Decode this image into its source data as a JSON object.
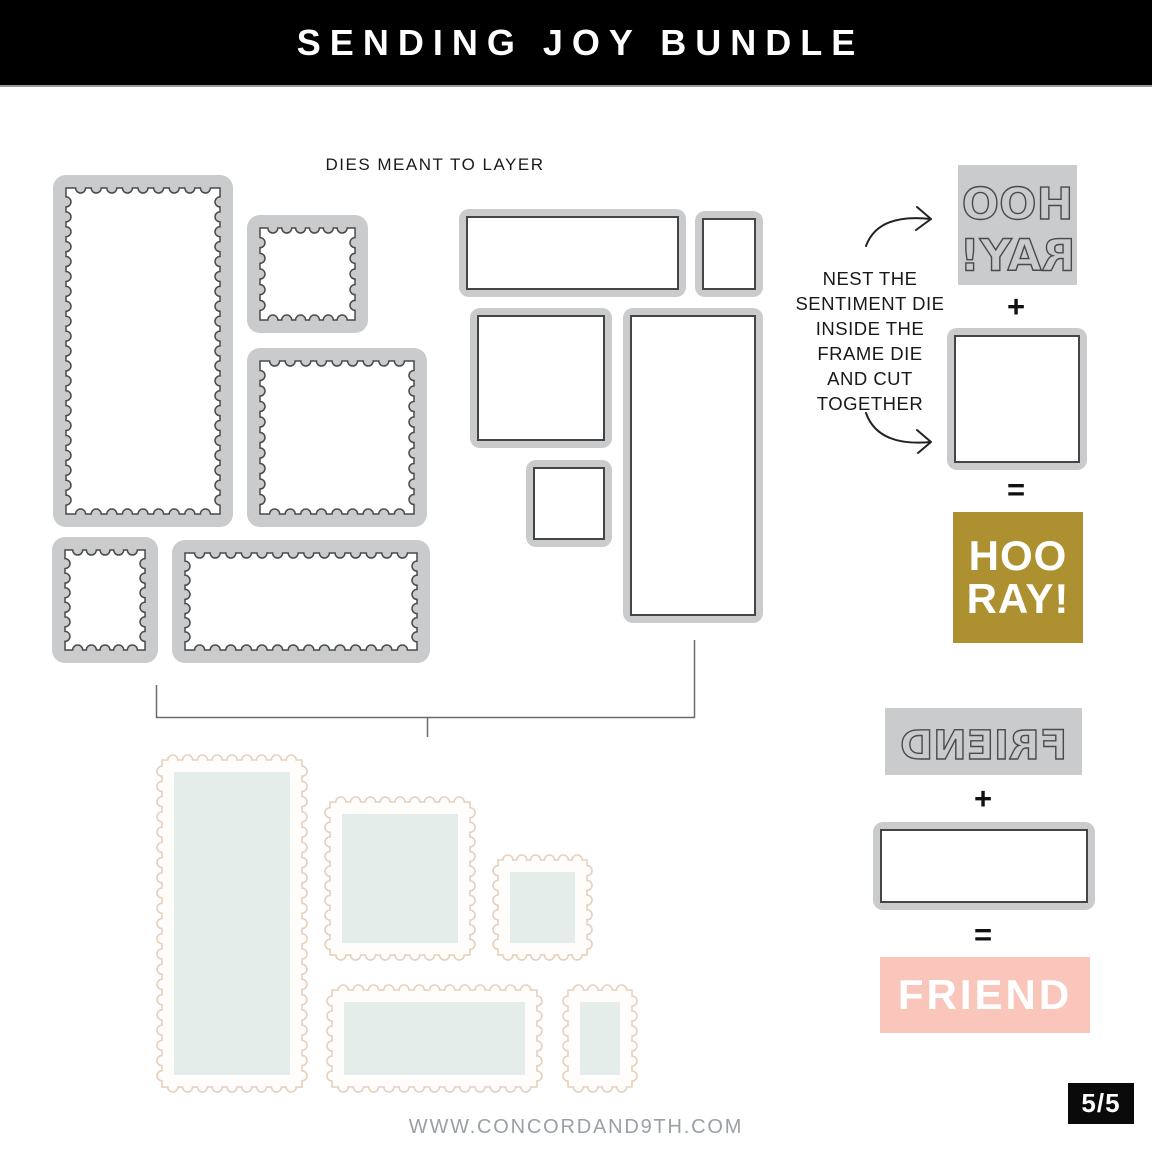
{
  "header": {
    "title": "SENDING JOY BUNDLE"
  },
  "dies_label": "DIES MEANT TO LAYER",
  "instruction": {
    "lines": [
      "NEST THE",
      "SENTIMENT DIE",
      "INSIDE THE",
      "FRAME DIE",
      "AND CUT",
      "TOGETHER"
    ]
  },
  "operators": {
    "plus": "+",
    "equals": "="
  },
  "sentiments": {
    "hooray": {
      "line1": "HOO",
      "line2": "RAY!"
    },
    "friend": {
      "text": "FRIEND"
    }
  },
  "footer": {
    "website": "WWW.CONCORDAND9TH.COM",
    "page_indicator": "5/5"
  },
  "colors": {
    "gold": "#ad9030",
    "pink": "#fac5bb",
    "mint": "#e4ede9",
    "die_gray": "#c9cbcc",
    "die_line": "#4a4a4a",
    "stamp_edge": "#e6d0bd",
    "header_bg": "#000000",
    "footer_text": "#9aa0a3"
  }
}
